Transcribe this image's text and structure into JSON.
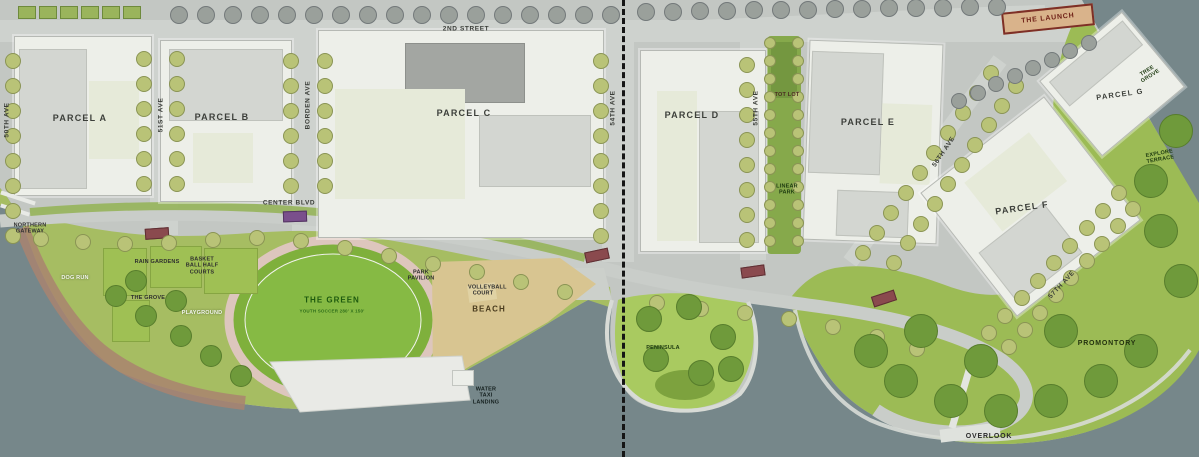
{
  "map": {
    "parcels": {
      "a": "PARCEL A",
      "b": "PARCEL B",
      "c": "PARCEL C",
      "d": "PARCEL D",
      "e": "PARCEL E",
      "f": "PARCEL F",
      "g": "PARCEL G"
    },
    "streets": {
      "second": "2ND STREET",
      "center_blvd": "CENTER BLVD",
      "borden": "BORDEN AVE",
      "ave50": "50TH AVE",
      "ave51": "51ST AVE",
      "ave54": "54TH AVE",
      "ave55": "55TH AVE",
      "ave56": "56TH AVE",
      "ave57": "57TH AVE"
    },
    "features": {
      "northern_gateway": "NORTHERN GATEWAY",
      "rain_gardens": "RAIN GARDENS",
      "basketball_half_courts": "BASKET BALL HALF COURTS",
      "dog_run": "DOG RUN",
      "the_grove": "THE GROVE",
      "playground": "PLAYGROUND",
      "the_green": "THE GREEN",
      "the_green_subtitle": "YOUTH SOCCER 280' X 150'",
      "park_pavilion": "PARK PAVILION",
      "volleyball_court": "VOLLEYBALL COURT",
      "beach": "BEACH",
      "water_taxi_landing": "WATER TAXI LANDING",
      "tot_lot": "TOT LOT",
      "linear_park": "LINEAR PARK",
      "peninsula": "PENINSULA",
      "promontory": "PROMONTORY",
      "overlook": "OVERLOOK",
      "the_launch": "THE LAUNCH",
      "tree_grove": "TREE GROVE",
      "explore_terrace": "EXPLORE TERRACE"
    },
    "colors": {
      "water": "#76878a",
      "street_gray": "#c3c7c3",
      "parcel_white": "#edefe9",
      "building_gray": "#d3d6d1",
      "building_dark": "#a3a6a2",
      "park_green": "#a6bd62",
      "oval_green": "#7fb03c",
      "beach_sand": "#d8c591",
      "track_pink": "#ddc6bd",
      "launch_red": "#7e2f26",
      "tree_olive": "#b9c377",
      "tree_gray": "#9aa09b"
    }
  }
}
